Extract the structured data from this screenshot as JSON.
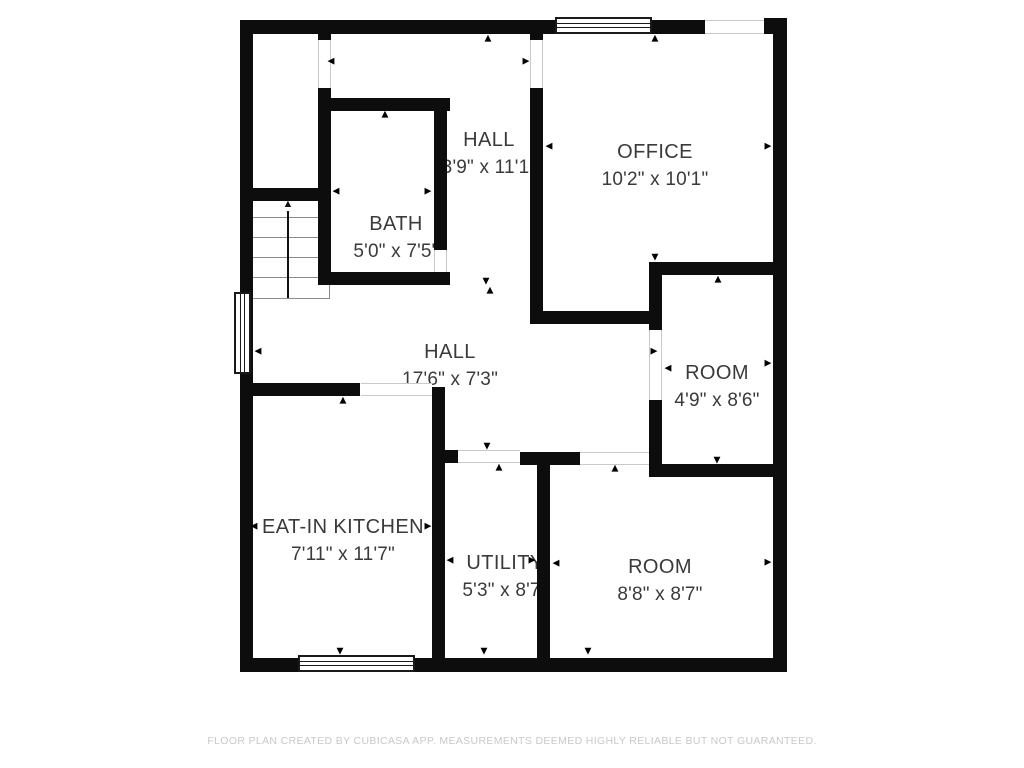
{
  "rooms": [
    {
      "id": "hall-upper",
      "name": "HALL",
      "dimensions": "3'9\" x 11'1\""
    },
    {
      "id": "office",
      "name": "OFFICE",
      "dimensions": "10'2\" x 10'1\""
    },
    {
      "id": "bath",
      "name": "BATH",
      "dimensions": "5'0\" x 7'5\""
    },
    {
      "id": "hall-main",
      "name": "HALL",
      "dimensions": "17'6\" x 7'3\""
    },
    {
      "id": "room-right",
      "name": "ROOM",
      "dimensions": "4'9\" x 8'6\""
    },
    {
      "id": "eat-in-kitchen",
      "name": "EAT-IN KITCHEN",
      "dimensions": "7'11\" x 11'7\""
    },
    {
      "id": "utility",
      "name": "UTILITY",
      "dimensions": "5'3\" x 8'7\""
    },
    {
      "id": "room-bottom",
      "name": "ROOM",
      "dimensions": "8'8\" x 8'7\""
    }
  ],
  "icons": {
    "arrow_up": "▲",
    "arrow_down": "▼",
    "arrow_left": "◀",
    "arrow_right": "▶"
  },
  "colors": {
    "wall": "#0d0d0d",
    "text": "#3a3a3a",
    "faint": "#c9c9c9"
  },
  "footer": {
    "disclaimer": "FLOOR PLAN CREATED BY CUBICASA APP. MEASUREMENTS DEEMED HIGHLY RELIABLE BUT NOT GUARANTEED."
  }
}
